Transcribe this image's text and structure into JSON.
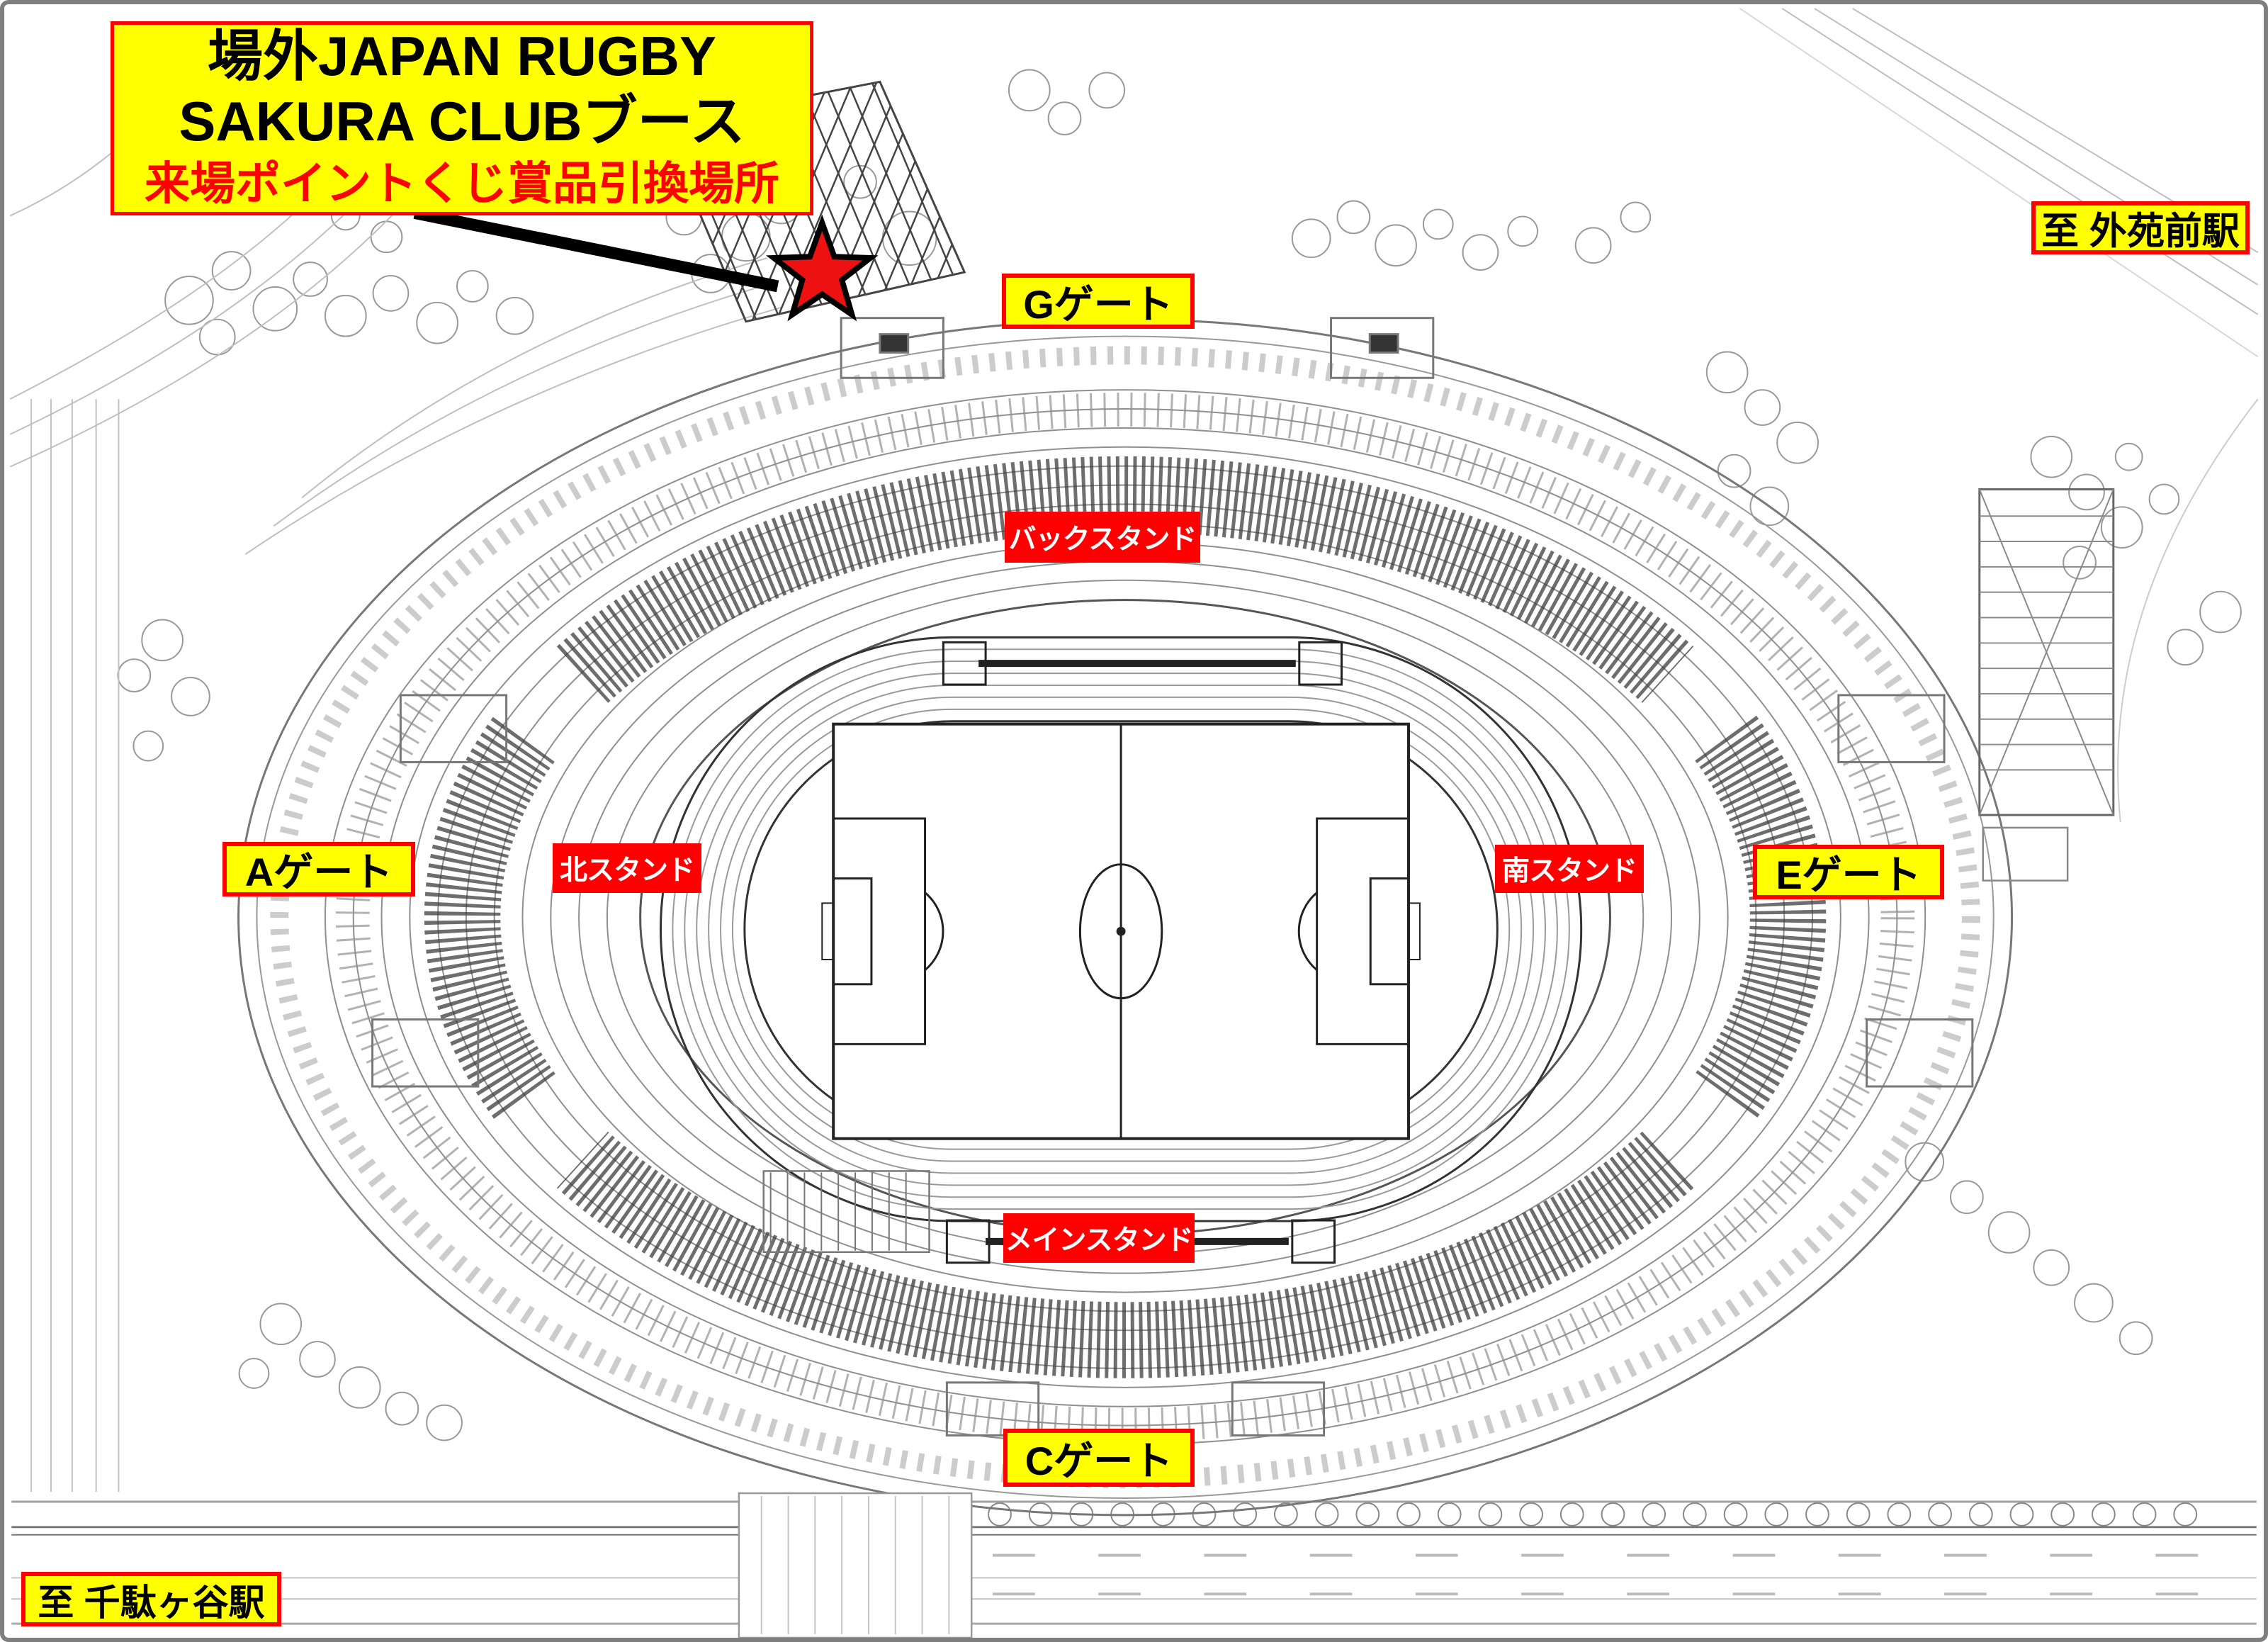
{
  "title_callout": {
    "line1": "場外JAPAN RUGBY",
    "line2": "SAKURA CLUBブース",
    "line3": "来場ポイントくじ賞品引換場所"
  },
  "marker": {
    "shape": "star",
    "fill": "#ee1111",
    "outline": "#000000"
  },
  "gates": [
    {
      "id": "G",
      "label": "Gゲート"
    },
    {
      "id": "A",
      "label": "Aゲート"
    },
    {
      "id": "E",
      "label": "Eゲート"
    },
    {
      "id": "C",
      "label": "Cゲート"
    }
  ],
  "stands": [
    {
      "id": "back",
      "label": "バックスタンド"
    },
    {
      "id": "north",
      "label": "北スタンド"
    },
    {
      "id": "south",
      "label": "南スタンド"
    },
    {
      "id": "main",
      "label": "メインスタンド"
    }
  ],
  "stations": [
    {
      "id": "gaiemmae",
      "label": "至 外苑前駅"
    },
    {
      "id": "sendagaya",
      "label": "至 千駄ヶ谷駅"
    }
  ],
  "colors": {
    "highlight_bg": "#ffff00",
    "highlight_border": "#ff0000",
    "stand_bg": "#ff0000",
    "stand_text": "#ffffff",
    "text": "#000000",
    "frame_border": "#7f7f7f"
  }
}
